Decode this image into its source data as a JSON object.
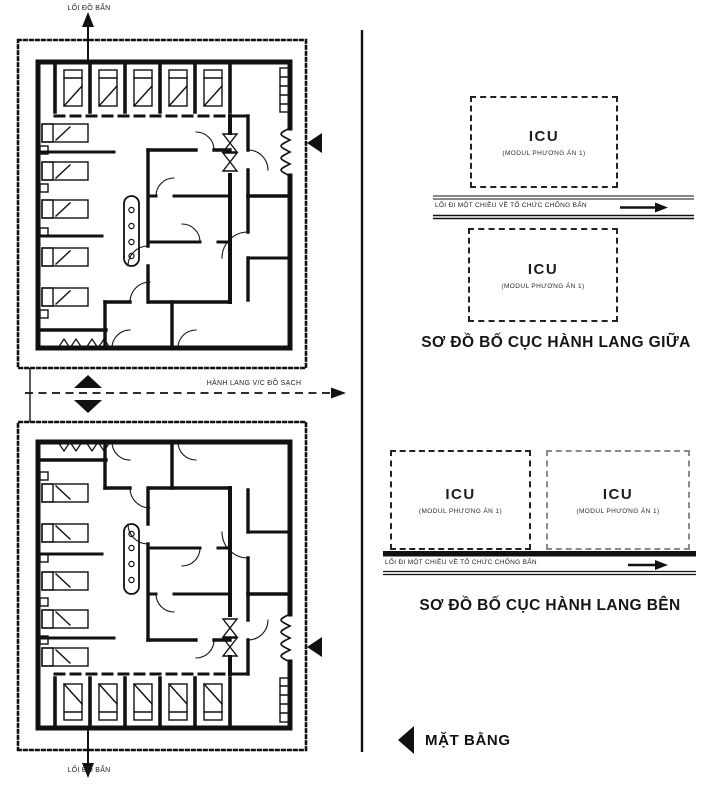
{
  "drawing": {
    "caption": "MẶT BẰNG",
    "floor_plans": {
      "top_exit_label": "LỐI ĐỒ BẨN",
      "bottom_exit_label": "LỐI ĐỒ BẨN",
      "middle_corridor_label": "HÀNH LANG V/C ĐỒ SẠCH"
    },
    "middle_corridor_diagram": {
      "title": "SƠ ĐỒ BỐ CỤC HÀNH LANG GIỮA",
      "flow_label": "LỐI ĐI MỘT CHIỀU VỀ TỔ CHỨC CHỐNG BẨN",
      "modules": [
        {
          "name": "ICU",
          "subtitle": "(MODUL PHƯƠNG ÁN 1)"
        },
        {
          "name": "ICU",
          "subtitle": "(MODUL PHƯƠNG ÁN 1)"
        }
      ]
    },
    "side_corridor_diagram": {
      "title": "SƠ ĐỒ BỐ CỤC HÀNH LANG BÊN",
      "flow_label": "LỐI ĐI MỘT CHIỀU VỀ TỔ CHỨC CHỐNG BẨN",
      "modules": [
        {
          "name": "ICU",
          "subtitle": "(MODUL PHƯƠNG ÁN 1)"
        },
        {
          "name": "ICU",
          "subtitle": "(MODUL PHƯƠNG ÁN 1)"
        }
      ]
    },
    "colors": {
      "ink": "#111111",
      "background": "#ffffff",
      "light_dash": "#8a8a8a"
    }
  }
}
